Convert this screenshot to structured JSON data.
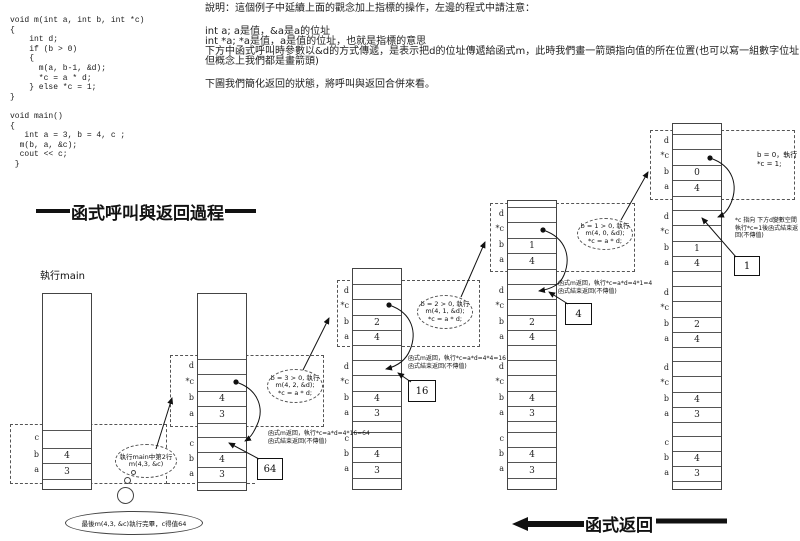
{
  "code": {
    "text": "void m(int a, int b, int *c)\n{\n    int d;\n    if (b > 0)\n    {\n      m(a, b-1, &d);\n      *c = a * d;\n    } else *c = 1;\n}\n\nvoid main()\n{\n   int a = 3, b = 4, c ;\n  m(b, a, &c);\n  cout << c;\n }"
  },
  "notes": {
    "lines": [
      "說明：這個例子中延續上面的觀念加上指標的操作，左邊的程式中請注意：",
      "int a; a是值，&a是a的位址",
      "int *a; *a是值，a是值的位址，也就是指標的意思",
      "下方中函式呼叫時參數以&d的方式傳遞，是表示把d的位址傳遞給函式m，此時我們畫一箭頭指向值的所在位置(也可以寫一組數字位址…",
      "但概念上我們都是畫箭頭)",
      "下圖我們簡化返回的狀態，將呼叫與返回合併來看。"
    ]
  },
  "title": {
    "text": "函式呼叫與返回過程"
  },
  "exec_label": {
    "text": "執行main"
  },
  "footer": {
    "text": "函式返回"
  },
  "final_bubble": {
    "text": "最後m(4,3, &c)執行完畢，c得值64"
  },
  "stacks": [
    {
      "name": "main",
      "x": 42,
      "top": 293,
      "width": 50,
      "rows": [
        {
          "h": 136
        },
        {
          "l": "c",
          "h": 18
        },
        {
          "l": "b",
          "v": "4",
          "h": 15
        },
        {
          "l": "a",
          "v": "3",
          "h": 16
        },
        {
          "h": 10
        }
      ]
    },
    {
      "name": "call-m-4-3",
      "x": 197,
      "top": 293,
      "width": 50,
      "rows": [
        {
          "h": 65
        },
        {
          "l": "d",
          "h": 15
        },
        {
          "l": "*c",
          "h": 17
        },
        {
          "l": "b",
          "v": "4",
          "h": 15
        },
        {
          "l": "a",
          "v": "3",
          "h": 17
        },
        {
          "h": 14
        },
        {
          "l": "c",
          "h": 15
        },
        {
          "l": "b",
          "v": "4",
          "h": 15
        },
        {
          "l": "a",
          "v": "3",
          "h": 15
        },
        {
          "h": 8
        }
      ]
    },
    {
      "name": "call-m-4-2",
      "x": 352,
      "top": 268,
      "width": 50,
      "rows": [
        {
          "h": 15
        },
        {
          "l": "d",
          "h": 15
        },
        {
          "l": "*c",
          "h": 16
        },
        {
          "l": "b",
          "v": "2",
          "h": 15
        },
        {
          "l": "a",
          "v": "4",
          "h": 15
        },
        {
          "h": 15
        },
        {
          "l": "d",
          "h": 15
        },
        {
          "l": "*c",
          "h": 16
        },
        {
          "l": "b",
          "v": "4",
          "h": 15
        },
        {
          "l": "a",
          "v": "3",
          "h": 15
        },
        {
          "h": 11
        },
        {
          "l": "c",
          "h": 15
        },
        {
          "l": "b",
          "v": "4",
          "h": 15
        },
        {
          "l": "a",
          "v": "3",
          "h": 16
        },
        {
          "h": 11
        }
      ]
    },
    {
      "name": "call-m-4-1",
      "x": 507,
      "top": 200,
      "width": 50,
      "rows": [
        {
          "h": 6
        },
        {
          "l": "d",
          "h": 15
        },
        {
          "l": "*c",
          "h": 16
        },
        {
          "l": "b",
          "v": "1",
          "h": 15
        },
        {
          "l": "a",
          "v": "4",
          "h": 16
        },
        {
          "h": 15
        },
        {
          "l": "d",
          "h": 15
        },
        {
          "l": "*c",
          "h": 16
        },
        {
          "l": "b",
          "v": "2",
          "h": 15
        },
        {
          "l": "a",
          "v": "4",
          "h": 15
        },
        {
          "h": 15
        },
        {
          "l": "d",
          "h": 15
        },
        {
          "l": "*c",
          "h": 16
        },
        {
          "l": "b",
          "v": "4",
          "h": 15
        },
        {
          "l": "a",
          "v": "3",
          "h": 15
        },
        {
          "h": 11
        },
        {
          "l": "c",
          "h": 15
        },
        {
          "l": "b",
          "v": "4",
          "h": 15
        },
        {
          "l": "a",
          "v": "3",
          "h": 16
        },
        {
          "h": 11
        }
      ]
    },
    {
      "name": "call-m-4-0",
      "x": 672,
      "top": 123,
      "width": 50,
      "rows": [
        {
          "h": 10
        },
        {
          "l": "d",
          "h": 15
        },
        {
          "l": "*c",
          "h": 16
        },
        {
          "l": "b",
          "v": "0",
          "h": 15
        },
        {
          "l": "a",
          "v": "4",
          "h": 16
        },
        {
          "h": 14
        },
        {
          "l": "d",
          "h": 15
        },
        {
          "l": "*c",
          "h": 16
        },
        {
          "l": "b",
          "v": "1",
          "h": 15
        },
        {
          "l": "a",
          "v": "4",
          "h": 15
        },
        {
          "h": 15
        },
        {
          "l": "d",
          "h": 15
        },
        {
          "l": "*c",
          "h": 16
        },
        {
          "l": "b",
          "v": "2",
          "h": 15
        },
        {
          "l": "a",
          "v": "4",
          "h": 15
        },
        {
          "h": 14
        },
        {
          "l": "d",
          "h": 15
        },
        {
          "l": "*c",
          "h": 16
        },
        {
          "l": "b",
          "v": "4",
          "h": 15
        },
        {
          "l": "a",
          "v": "3",
          "h": 15
        },
        {
          "h": 14
        },
        {
          "l": "c",
          "h": 15
        },
        {
          "l": "b",
          "v": "4",
          "h": 15
        },
        {
          "l": "a",
          "v": "3",
          "h": 15
        },
        {
          "h": 8
        }
      ]
    }
  ],
  "frame_boxes": [
    {
      "x": 10,
      "y": 424,
      "w": 157,
      "h": 60
    },
    {
      "x": 170,
      "y": 355,
      "w": 154,
      "h": 72
    },
    {
      "x": 337,
      "y": 280,
      "w": 143,
      "h": 67
    },
    {
      "x": 490,
      "y": 203,
      "w": 145,
      "h": 69
    },
    {
      "x": 650,
      "y": 130,
      "w": 145,
      "h": 70
    }
  ],
  "callouts": [
    {
      "cx": 146,
      "cy": 461,
      "rx": 31,
      "ry": 17,
      "lines": [
        "執行main中第2行",
        "m(4,3, &c)"
      ]
    },
    {
      "cx": 295,
      "cy": 386,
      "rx": 28,
      "ry": 17,
      "lines": [
        "b = 3 > 0, 執行",
        "m(4, 2, &d);",
        "*c = a * d;"
      ]
    },
    {
      "cx": 445,
      "cy": 312,
      "rx": 28,
      "ry": 17,
      "lines": [
        "b = 2 > 0, 執行",
        "m(4, 1, &d);",
        "*c = a * d;"
      ]
    },
    {
      "cx": 605,
      "cy": 234,
      "rx": 28,
      "ry": 16,
      "lines": [
        "b = 1 > 0, 執行",
        "m(4, 0, &d);",
        "*c = a * d;"
      ]
    }
  ],
  "base_case_note": {
    "x": 757,
    "y": 151,
    "lines": [
      "b = 0，執行",
      "*c = 1;"
    ]
  },
  "value_boxes": [
    {
      "text": "64",
      "x": 257,
      "y": 458,
      "w": 26,
      "h": 22
    },
    {
      "text": "16",
      "x": 408,
      "y": 380,
      "w": 28,
      "h": 22
    },
    {
      "text": "4",
      "x": 565,
      "y": 303,
      "w": 27,
      "h": 22
    },
    {
      "text": "1",
      "x": 734,
      "y": 256,
      "w": 26,
      "h": 20
    }
  ],
  "return_notes": [
    {
      "x": 268,
      "y": 430,
      "lines": [
        "函式m返回，執行*c=a*d=4*16=64",
        "函式結束返回(不傳值)"
      ]
    },
    {
      "x": 408,
      "y": 355,
      "lines": [
        "函式m返回，執行*c=a*d=4*4=16",
        "函式結束返回(不傳值)"
      ]
    },
    {
      "x": 558,
      "y": 280,
      "lines": [
        "函式m返回，執行*c=a*d=4*1=4",
        "函式結束返回(不傳值)"
      ]
    },
    {
      "x": 735,
      "y": 217,
      "lines": [
        "*c 指向 下方d變數空間",
        "執行*c=1後函式結束返",
        "回(不傳值)"
      ]
    }
  ],
  "bubble_circles": [
    {
      "x": 131,
      "y": 470,
      "d": 5
    },
    {
      "x": 124,
      "y": 477,
      "d": 7
    },
    {
      "x": 117,
      "y": 487,
      "d": 17
    }
  ],
  "bubble_ellipse": {
    "x": 65,
    "y": 511,
    "w": 138,
    "h": 24
  },
  "arrows": [
    {
      "name": "arrow-call-1",
      "path": "M 156,449 L 172,398"
    },
    {
      "name": "arrow-call-2",
      "path": "M 303,370 L 329,318"
    },
    {
      "name": "arrow-call-3",
      "path": "M 461,297 L 485,242"
    },
    {
      "name": "arrow-call-4",
      "path": "M 621,220 L 648,172"
    },
    {
      "name": "pointer-arc-1",
      "dot": [
        236,
        382
      ],
      "path": "M 236,382 C 260,390 264,410 257,425 C 253,434 250,438 245,441"
    },
    {
      "name": "pointer-arc-2",
      "dot": [
        389,
        305
      ],
      "path": "M 389,305 C 413,313 417,333 410,350 C 406,360 398,366 386,369"
    },
    {
      "name": "pointer-arc-3",
      "dot": [
        543,
        230
      ],
      "path": "M 543,230 C 567,238 571,258 564,275 C 560,285 551,289 539,291"
    },
    {
      "name": "pointer-arc-4",
      "dot": [
        710,
        158
      ],
      "path": "M 710,158 C 734,166 738,186 731,203 C 727,212 723,215 718,217"
    },
    {
      "name": "arrow-value-64",
      "path": "M 259,459 L 229,443"
    },
    {
      "name": "arrow-value-16",
      "path": "M 411,382 L 398,373"
    },
    {
      "name": "arrow-value-4",
      "path": "M 568,304 L 549,292"
    },
    {
      "name": "arrow-value-1",
      "path": "M 736,257 L 702,218"
    }
  ],
  "dashed_segments": [
    {
      "x1": 167,
      "y1": 483,
      "x2": 255,
      "y2": 483
    }
  ],
  "title_bars": [
    {
      "w": 34
    },
    {
      "w": 31
    }
  ],
  "footer_arrow": {
    "tip_x": 512,
    "y": 524,
    "shaft_end": 584,
    "bar_x": 656,
    "bar_end": 727
  }
}
